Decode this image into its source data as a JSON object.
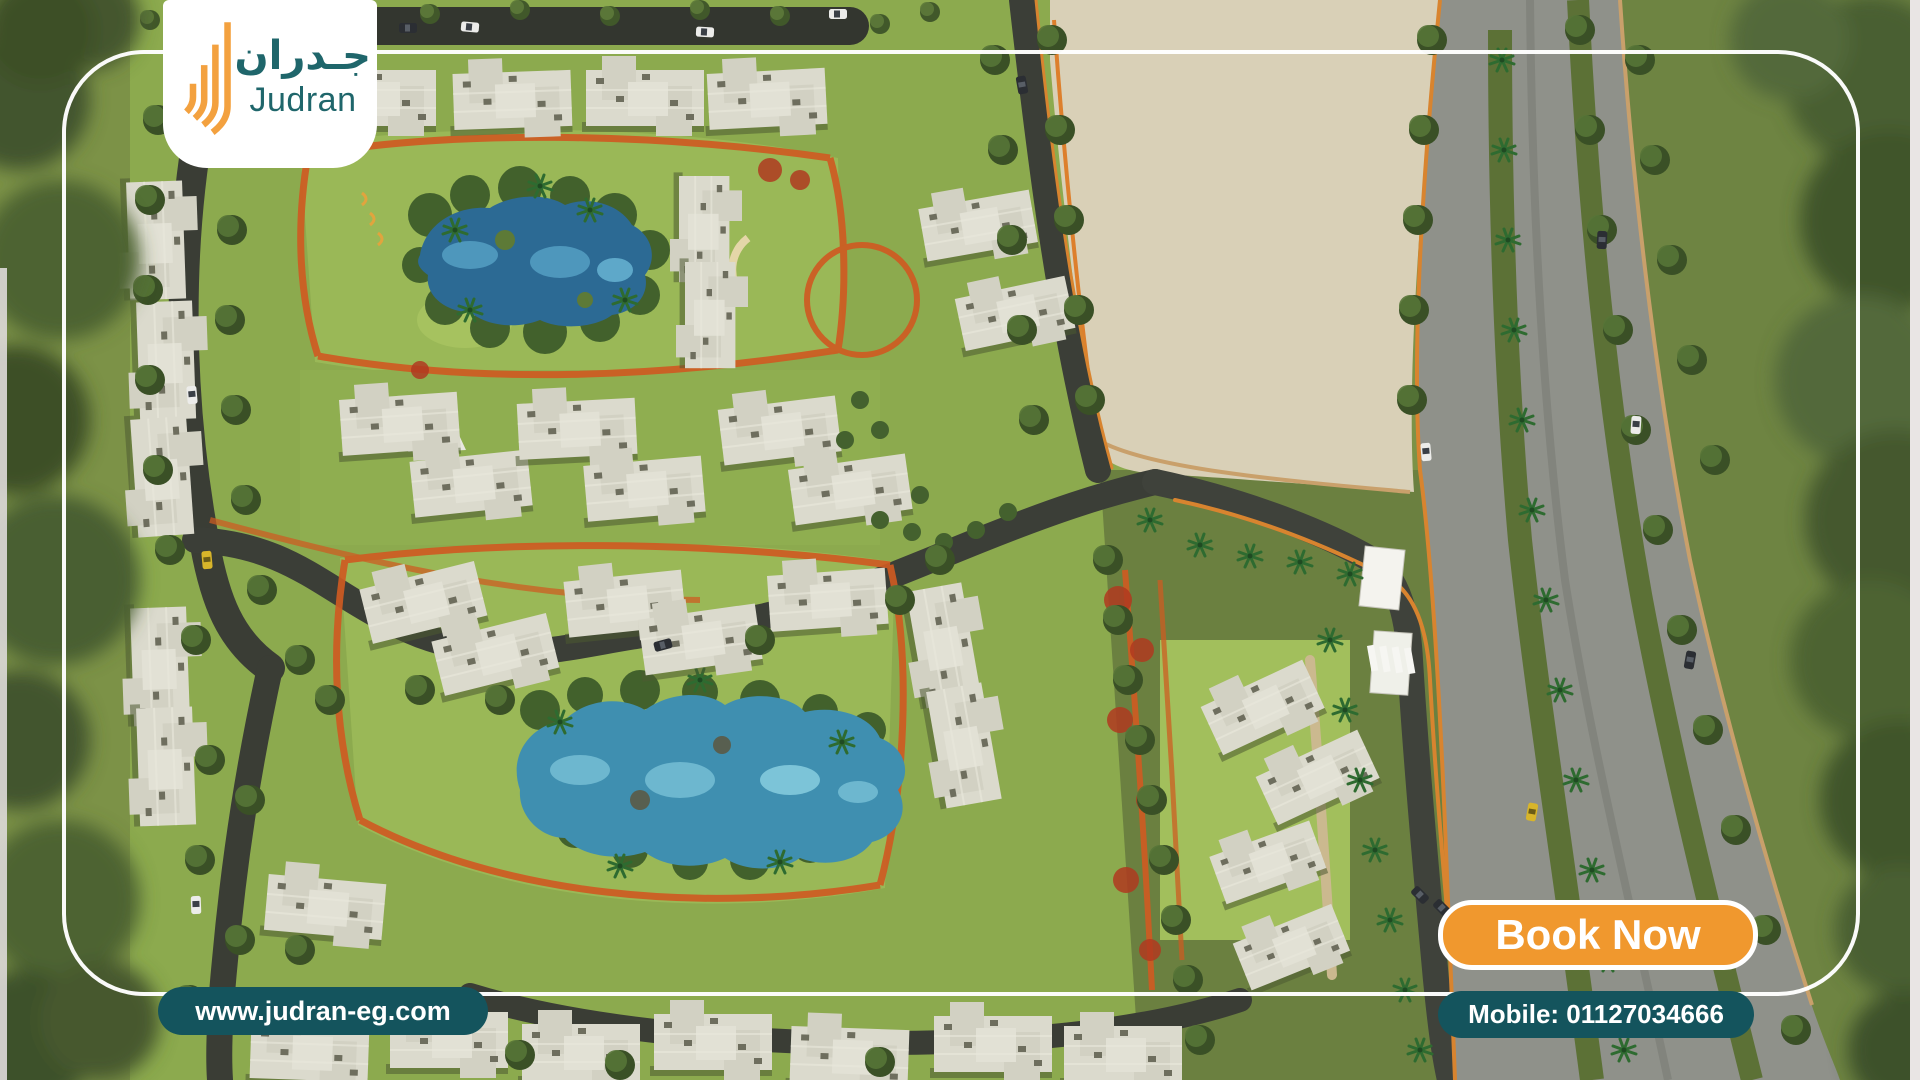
{
  "brand": {
    "name_arabic": "جـدران",
    "name_latin": "Judran",
    "icon": "judran-bars-icon"
  },
  "overlay": {
    "website": "www.judran-eg.com",
    "book_now": "Book Now",
    "mobile": "Mobile: 01127034666"
  },
  "colors": {
    "teal": "#14545D",
    "orange": "#F0982E",
    "logoTeal": "#1F666B",
    "logoOrange": "#F3A13F"
  }
}
